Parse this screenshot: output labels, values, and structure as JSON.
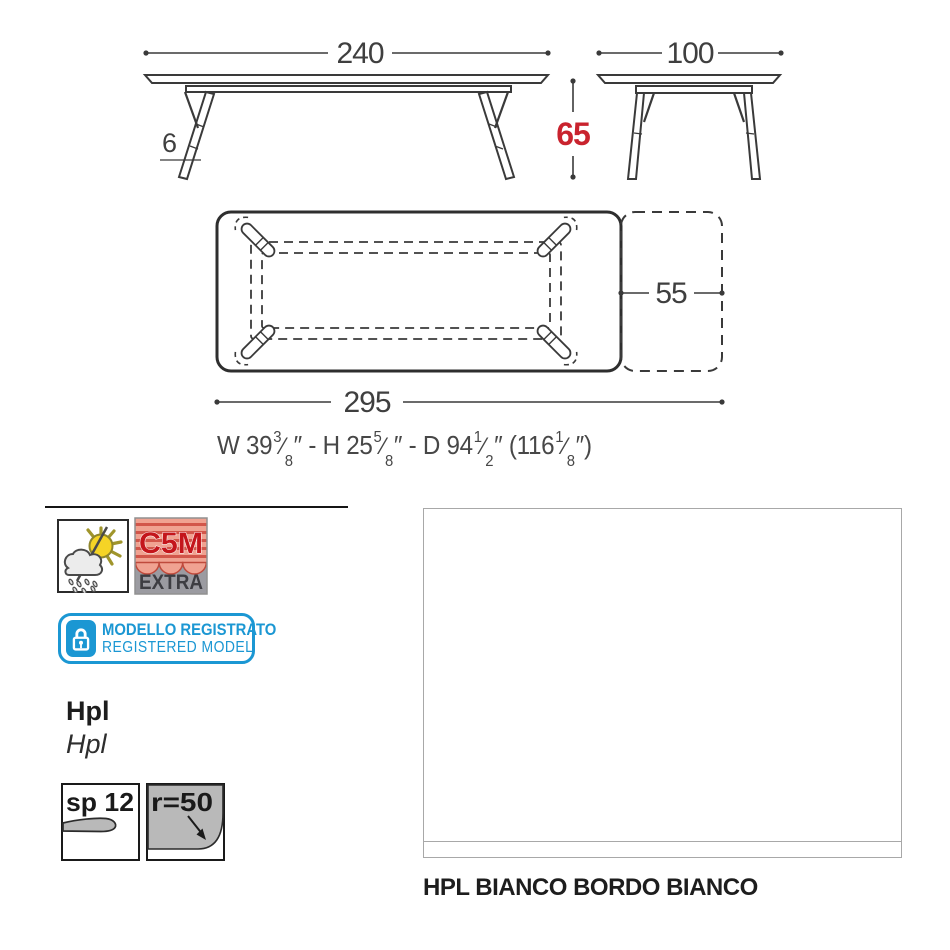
{
  "drawing": {
    "front_view": {
      "width": "240",
      "leg_thickness": "6"
    },
    "side_view": {
      "depth": "100",
      "height": "65"
    },
    "top_view": {
      "extension": "55",
      "total_length": "295"
    },
    "imperial": {
      "p1": "W 39",
      "f1n": "3",
      "f1d": "8",
      "p2": "″ - H 25",
      "f2n": "5",
      "f2d": "8",
      "p3": "″ - D 94",
      "f3n": "1",
      "f3d": "2",
      "p4": "″ (116",
      "f4n": "1",
      "f4d": "8",
      "p5": "″)",
      "slash": "⁄"
    }
  },
  "badges": {
    "weather_icon": "sun-cloud-rain-outdoor-icon",
    "c5m": {
      "line1": "C5M",
      "line2": "EXTRA"
    },
    "registered": {
      "line1": "MODELLO REGISTRATO",
      "line2": "REGISTERED MODEL",
      "lock_icon": "padlock-icon"
    }
  },
  "material": {
    "primary": "Hpl",
    "secondary": "Hpl"
  },
  "specs": {
    "thickness": "sp 12",
    "radius": "r=50"
  },
  "finish": {
    "caption": "HPL BIANCO BORDO BIANCO"
  },
  "colors": {
    "line": "#3a3a3a",
    "accent_red": "#c9232e",
    "badge_cyan": "#1b97d3",
    "c5m_red": "#c4161c",
    "c5m_salmon": "#f0a291",
    "c5m_stripe": "#d2564a",
    "c5m_gray": "#9b9ba1",
    "sun_yellow": "#f5d426",
    "shape_gray": "#b9b9b9",
    "swatch_border": "#a8a8a8",
    "text_dark": "#1d1d1d"
  }
}
